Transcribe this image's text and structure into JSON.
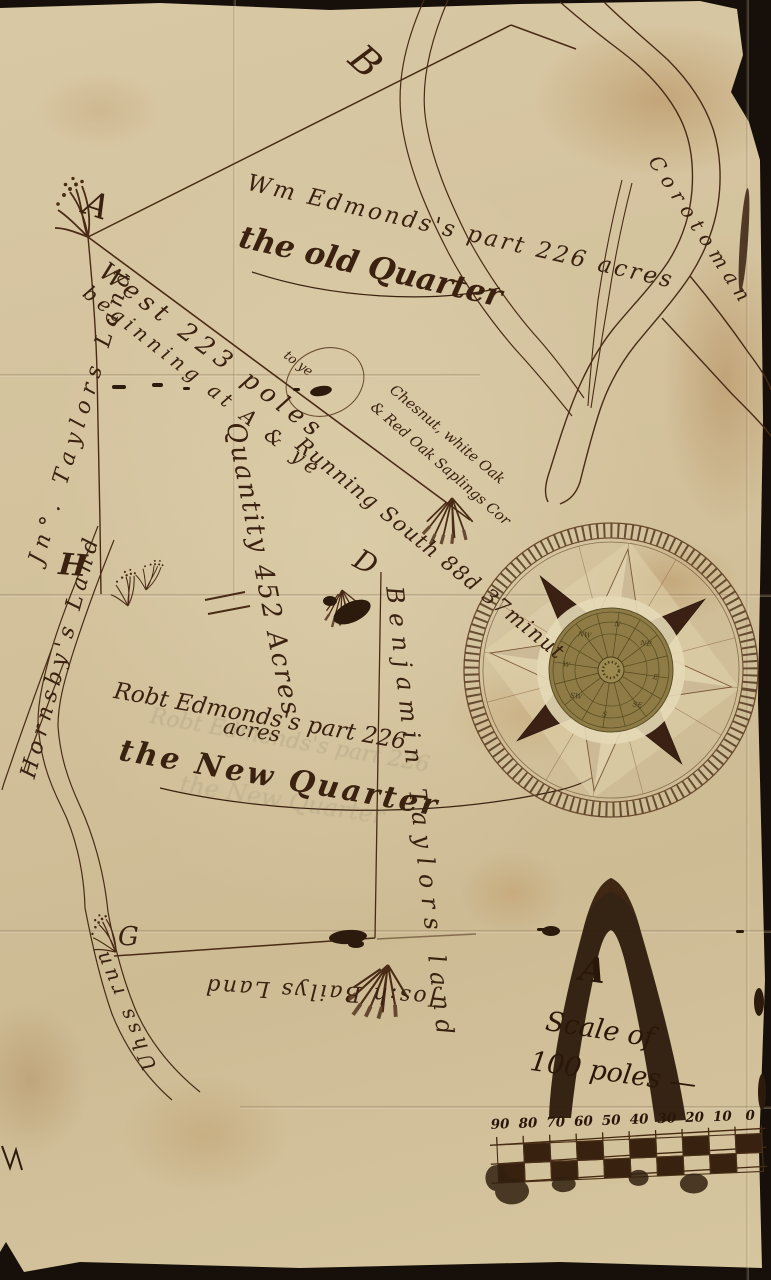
{
  "colors": {
    "paper": "#d5c5a0",
    "ink": "#4a2b15",
    "dark_ink": "#2e1b0d",
    "brass_medallion": "#8e7b45",
    "backdrop": "#17100a"
  },
  "labels": {
    "corner_a": "A",
    "corner_b": "B",
    "corner_d": "D",
    "corner_g": "G",
    "corner_h": "H"
  },
  "annotations": {
    "owner_old": "Wm Edmonds's part 226 acres",
    "old_quarter": "the old Quarter",
    "west_line": "West 223 poles",
    "to_ye": "to ye",
    "beginning": "beginning at A & ye",
    "bearing": "Running South 88d 37minut",
    "corner_trees_1": "Chesnut, white Oak",
    "corner_trees_2": "& Red Oak Saplings Cor",
    "jn_taylors_land": "Jn°. Taylors Land",
    "hornsbys_land": "Hornsby's Land",
    "quantity": "Quantity 452 Acres",
    "owner_new": "Robt Edmonds's part 226",
    "owner_new_2": "acres",
    "new_quarter": "the New Quarter",
    "benjamin_taylors_land": "Benjamin Taylors land",
    "river_name": "Corotoman",
    "jos_bailys_land": "Jos:h Bailys Land",
    "run_name": "Uhss run"
  },
  "compass": {
    "points": [
      "N",
      "NE",
      "E",
      "SE",
      "S",
      "SW",
      "W",
      "NW"
    ]
  },
  "scale": {
    "title_a": "A",
    "title_line2": "Scale of",
    "title_line3": "100 poles —",
    "ticks": [
      "90",
      "80",
      "70",
      "60",
      "50",
      "40",
      "30",
      "20",
      "10",
      "0"
    ]
  }
}
